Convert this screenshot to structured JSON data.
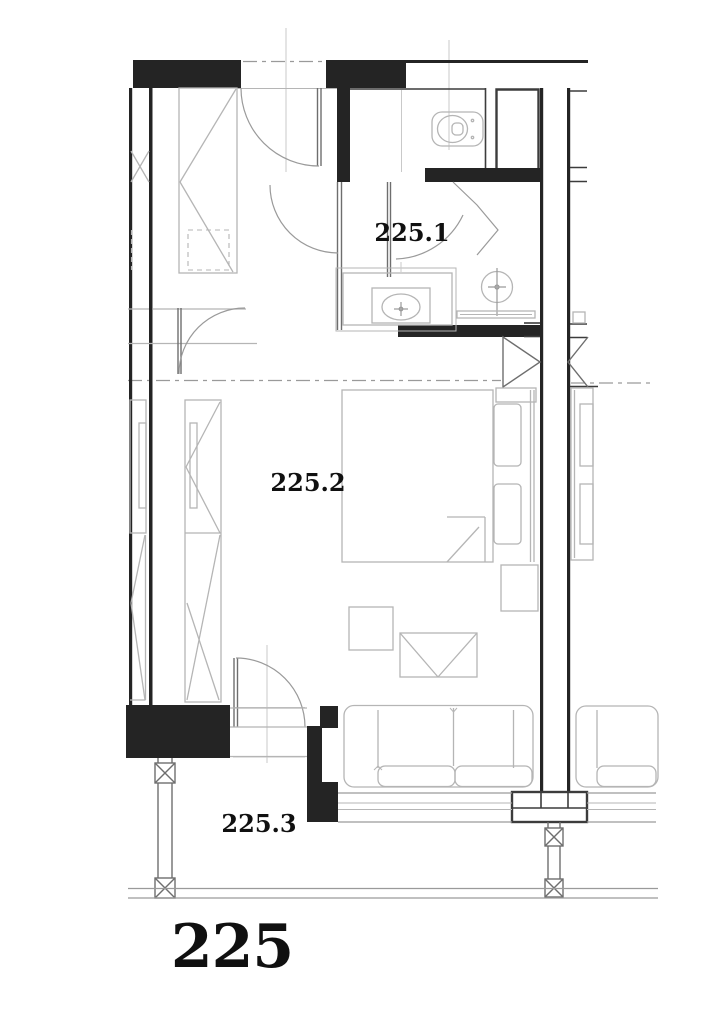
{
  "drawing": {
    "unit_label": "225",
    "rooms": [
      {
        "id": "room-1",
        "label": "225.1"
      },
      {
        "id": "room-2",
        "label": "225.2"
      },
      {
        "id": "room-3",
        "label": "225.3"
      }
    ],
    "fixtures": [
      "toilet",
      "washbasin",
      "shower",
      "bed",
      "pillows",
      "wardrobe",
      "closet",
      "sofa",
      "ottoman",
      "side-table",
      "nightstand",
      "balcony-posts",
      "doors"
    ],
    "colors": {
      "wall": "#242424",
      "wall_line": "#3c3c3c",
      "partition": "#6e6e6e",
      "furniture": "#b5b5b5",
      "medium": "#9a9a9a",
      "axis": "#c9c9c9",
      "label": "#101010",
      "background": "#ffffff"
    }
  }
}
